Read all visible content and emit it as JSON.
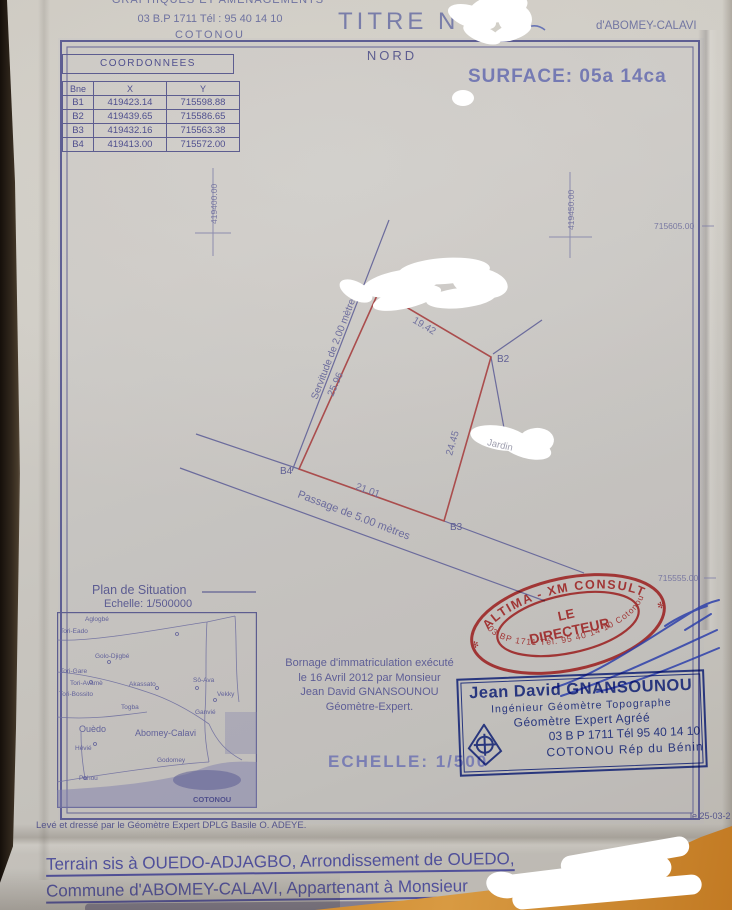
{
  "doc": {
    "header_org_line1": "GRAPHIQUES ET AMENAGEMENTS",
    "header_org_line2": "03 B.P 1711 Tél : 95 40 14 10",
    "header_org_line3": "COTONOU",
    "title": "TITRE N°",
    "region": "d'ABOMEY-CALAVI"
  },
  "north": "NORD",
  "surface": "SURFACE: 05a 14ca",
  "coords_table": {
    "title": "COORDONNEES",
    "col_pt": "Bne",
    "col_x": "X",
    "col_y": "Y",
    "rows": [
      {
        "pt": "B1",
        "x": "419423.14",
        "y": "715598.88"
      },
      {
        "pt": "B2",
        "x": "419439.65",
        "y": "715586.65"
      },
      {
        "pt": "B3",
        "x": "419432.16",
        "y": "715563.38"
      },
      {
        "pt": "B4",
        "x": "419413.00",
        "y": "715572.00"
      }
    ]
  },
  "drawing": {
    "grid_e_left": "419400.00",
    "grid_e_right": "419450.00",
    "grid_n_top": "715605.00",
    "grid_n_bottom": "715555.00",
    "servitude": "Servitude de 2.00 mètres",
    "passage": "Passage de 5.00 mètres",
    "jardin": "Jardin",
    "pt_b2": "B2",
    "pt_b3": "B3",
    "pt_b4": "B4",
    "len_b1b2": "19.42",
    "len_b2b3": "24.45",
    "len_b3b4": "21.01",
    "len_b4b1": "25.96"
  },
  "situation": {
    "title": "Plan de Situation",
    "scale": "Echelle: 1/500000",
    "places": [
      {
        "name": "Aglogbé"
      },
      {
        "name": "Tori-Eado"
      },
      {
        "name": "Golo-Djigbé"
      },
      {
        "name": "Tori-Gare"
      },
      {
        "name": "Tori-Avamè"
      },
      {
        "name": "Tori-Bossito"
      },
      {
        "name": "Akassato"
      },
      {
        "name": "Sô-Ava"
      },
      {
        "name": "Vekky"
      },
      {
        "name": "Togba"
      },
      {
        "name": "Ganvié"
      },
      {
        "name": "Ouèdo"
      },
      {
        "name": "Abomey-Calavi"
      },
      {
        "name": "Hêvié"
      },
      {
        "name": "Godomey"
      },
      {
        "name": "Pahou"
      },
      {
        "name": "COTONOU"
      }
    ]
  },
  "bornage": {
    "line1": "Bornage d'immatriculation exécuté",
    "line2": "le 16 Avril 2012 par Monsieur",
    "line3": "Jean David GNANSOUNOU",
    "line4": "Géomètre-Expert."
  },
  "scale_main": "ECHELLE: 1/500",
  "red_stamp": {
    "arc_top": "ALTIMA - XM CONSULT",
    "line1": "LE",
    "line2": "DIRECTEUR",
    "arc_bottom": "03 BP 1711 Tél. 95 40 14 10 Cotonou",
    "star": "✻"
  },
  "blue_stamp": {
    "line1": "Jean David GNANSOUNOU",
    "line2": "Ingénieur Géomètre Topographe",
    "line3": "Géomètre Expert Agréé",
    "line4": "03 B P 1711    Tél 95 40 14 10",
    "line5": "COTONOU     Rép du Bénin"
  },
  "footer": {
    "surveyor": "Levé et dressé par le Géomètre Expert DPLG Basile O. ADEYE.",
    "date": "le 25-03-2",
    "terrain1": "Terrain sis à OUEDO-ADJAGBO, Arrondissement de OUEDO,",
    "terrain2": "Commune d'ABOMEY-CALAVI, Appartenant à Monsieur"
  }
}
